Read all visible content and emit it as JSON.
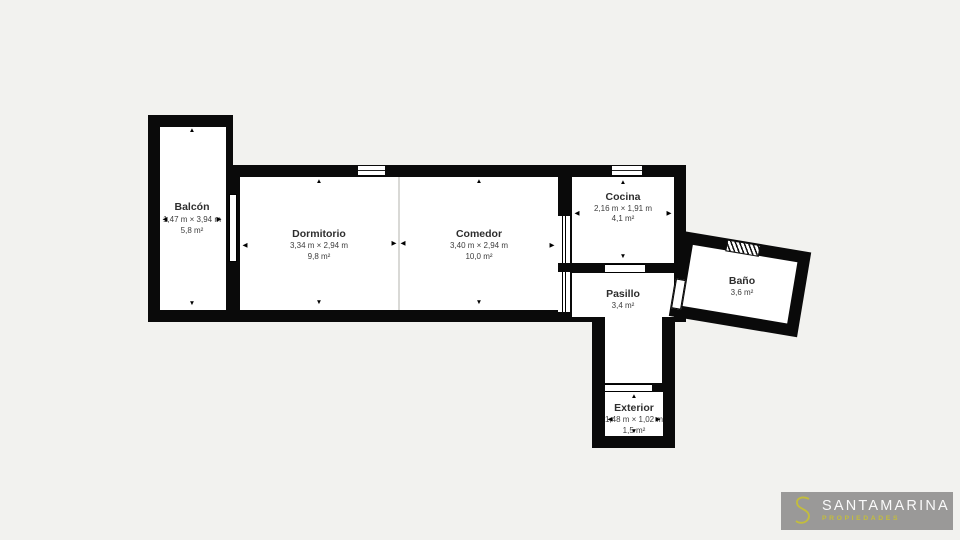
{
  "canvas": {
    "background_color": "#f2f2ef",
    "wall_color": "#0a0a0a",
    "floor_color": "#ffffff"
  },
  "rooms": {
    "balcon": {
      "name": "Balcón",
      "dims": "1,47 m × 3,94 m",
      "area": "5,8 m²"
    },
    "dormitorio": {
      "name": "Dormitorio",
      "dims": "3,34 m × 2,94 m",
      "area": "9,8 m²"
    },
    "comedor": {
      "name": "Comedor",
      "dims": "3,40 m × 2,94 m",
      "area": "10,0 m²"
    },
    "cocina": {
      "name": "Cocina",
      "dims": "2,16 m × 1,91 m",
      "area": "4,1 m²"
    },
    "pasillo": {
      "name": "Pasillo",
      "area": "3,4 m²"
    },
    "bano": {
      "name": "Baño",
      "area": "3,6 m²"
    },
    "exterior": {
      "name": "Exterior",
      "dims": "1,48 m × 1,02 m",
      "area": "1,5 m²"
    }
  },
  "glyphs": {
    "up": "▲",
    "down": "▼",
    "left": "◀",
    "right": "▶"
  },
  "logo": {
    "brand": "SANTAMARINA",
    "tagline": "PROPIEDADES",
    "box_color": "#9a9998",
    "accent_color": "#c3bd3c",
    "brand_color": "#fafafa"
  }
}
